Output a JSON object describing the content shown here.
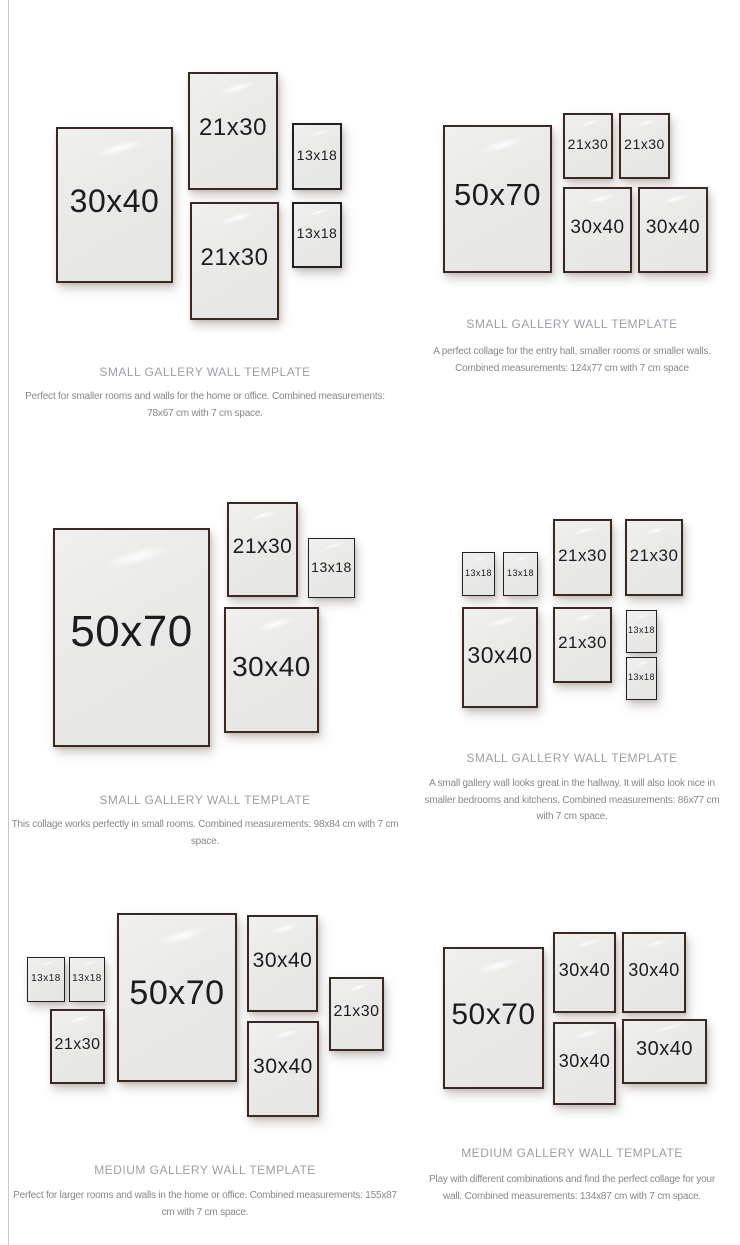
{
  "colors": {
    "background": "#ffffff",
    "left_rule": "#c7c9ca",
    "frame_border_brown": "#3a2821",
    "frame_border_black": "#212121",
    "frame_fill": "#e9e9e7",
    "title_text": "#9b9fa3",
    "desc_text": "#85888c",
    "label_text": "#1c1c1c"
  },
  "sections": [
    {
      "title": "SMALL GALLERY WALL TEMPLATE",
      "desc_lines": [
        "Perfect for smaller rooms and walls for the home or office. Combined measurements:",
        "78x67 cm with 7 cm space."
      ],
      "frames": [
        {
          "label": "30x40",
          "x": 56,
          "y": 127,
          "w": 117,
          "h": 156,
          "fs": 32
        },
        {
          "label": "21x30",
          "x": 188,
          "y": 72,
          "w": 90,
          "h": 118,
          "fs": 24
        },
        {
          "label": "13x18",
          "x": 292,
          "y": 123,
          "w": 50,
          "h": 67,
          "fs": 14
        },
        {
          "label": "21x30",
          "x": 190,
          "y": 202,
          "w": 89,
          "h": 118,
          "fs": 24
        },
        {
          "label": "13x18",
          "x": 292,
          "y": 202,
          "w": 50,
          "h": 66,
          "fs": 14
        }
      ]
    },
    {
      "title": "SMALL GALLERY WALL TEMPLATE",
      "desc_lines": [
        "A perfect collage for the entry hall, smaller rooms or smaller walls.",
        "Combined measurements: 124x77 cm with 7 cm space"
      ],
      "frames": [
        {
          "label": "50x70",
          "x": 443,
          "y": 125,
          "w": 109,
          "h": 148,
          "fs": 31
        },
        {
          "label": "21x30",
          "x": 563,
          "y": 113,
          "w": 50,
          "h": 66,
          "fs": 14
        },
        {
          "label": "21x30",
          "x": 619,
          "y": 113,
          "w": 51,
          "h": 66,
          "fs": 14
        },
        {
          "label": "30x40",
          "x": 563,
          "y": 187,
          "w": 69,
          "h": 86,
          "fs": 19
        },
        {
          "label": "30x40",
          "x": 638,
          "y": 187,
          "w": 70,
          "h": 86,
          "fs": 19
        }
      ]
    },
    {
      "title": "SMALL GALLERY WALL TEMPLATE",
      "desc_lines": [
        "This collage works perfectly in small rooms. Combined measurements: 98x84 cm with 7 cm",
        "space."
      ],
      "frames": [
        {
          "label": "50x70",
          "x": 53,
          "y": 528,
          "w": 157,
          "h": 219,
          "fs": 44
        },
        {
          "label": "21x30",
          "x": 227,
          "y": 502,
          "w": 71,
          "h": 95,
          "fs": 21
        },
        {
          "label": "13x18",
          "x": 308,
          "y": 538,
          "w": 47,
          "h": 60,
          "fs": 14
        },
        {
          "label": "30x40",
          "x": 224,
          "y": 607,
          "w": 95,
          "h": 126,
          "fs": 28
        }
      ]
    },
    {
      "title": "SMALL GALLERY WALL TEMPLATE",
      "desc_lines": [
        "A small gallery wall looks great in the hallway. It will also look nice in",
        "smaller bedrooms and kitchens. Combined measurements: 86x77 cm",
        "with 7 cm space."
      ],
      "frames": [
        {
          "label": "13x18",
          "x": 462,
          "y": 552,
          "w": 33,
          "h": 44,
          "fs": 9
        },
        {
          "label": "13x18",
          "x": 503,
          "y": 552,
          "w": 35,
          "h": 44,
          "fs": 9
        },
        {
          "label": "21x30",
          "x": 553,
          "y": 519,
          "w": 59,
          "h": 77,
          "fs": 17
        },
        {
          "label": "21x30",
          "x": 625,
          "y": 519,
          "w": 58,
          "h": 77,
          "fs": 17
        },
        {
          "label": "30x40",
          "x": 462,
          "y": 607,
          "w": 76,
          "h": 101,
          "fs": 23
        },
        {
          "label": "21x30",
          "x": 553,
          "y": 607,
          "w": 59,
          "h": 76,
          "fs": 17
        },
        {
          "label": "13x18",
          "x": 626,
          "y": 610,
          "w": 31,
          "h": 43,
          "fs": 9
        },
        {
          "label": "13x18",
          "x": 626,
          "y": 657,
          "w": 31,
          "h": 43,
          "fs": 9
        }
      ]
    },
    {
      "title": "MEDIUM GALLERY WALL TEMPLATE",
      "desc_lines": [
        "Perfect for larger rooms and walls in the home or office. Combined measurements: 155x87",
        "cm with 7 cm space."
      ],
      "frames": [
        {
          "label": "13x18",
          "x": 27,
          "y": 957,
          "w": 38,
          "h": 45,
          "fs": 10
        },
        {
          "label": "13x18",
          "x": 69,
          "y": 957,
          "w": 36,
          "h": 45,
          "fs": 10
        },
        {
          "label": "21x30",
          "x": 50,
          "y": 1009,
          "w": 55,
          "h": 75,
          "fs": 16
        },
        {
          "label": "50x70",
          "x": 117,
          "y": 913,
          "w": 120,
          "h": 169,
          "fs": 34
        },
        {
          "label": "30x40",
          "x": 247,
          "y": 915,
          "w": 71,
          "h": 97,
          "fs": 21
        },
        {
          "label": "30x40",
          "x": 247,
          "y": 1021,
          "w": 72,
          "h": 96,
          "fs": 21
        },
        {
          "label": "21x30",
          "x": 329,
          "y": 977,
          "w": 55,
          "h": 74,
          "fs": 16
        }
      ]
    },
    {
      "title": "MEDIUM GALLERY WALL TEMPLATE",
      "desc_lines": [
        "Play with different combinations and find the perfect collage for your",
        "wall. Combined measurements: 134x87 cm with 7 cm space."
      ],
      "frames": [
        {
          "label": "50x70",
          "x": 443,
          "y": 947,
          "w": 101,
          "h": 142,
          "fs": 30
        },
        {
          "label": "30x40",
          "x": 553,
          "y": 932,
          "w": 63,
          "h": 81,
          "fs": 18
        },
        {
          "label": "30x40",
          "x": 622,
          "y": 932,
          "w": 64,
          "h": 81,
          "fs": 18
        },
        {
          "label": "30x40",
          "x": 553,
          "y": 1022,
          "w": 63,
          "h": 83,
          "fs": 18
        },
        {
          "label": "30x40",
          "x": 622,
          "y": 1019,
          "w": 85,
          "h": 65,
          "fs": 20
        }
      ]
    }
  ]
}
